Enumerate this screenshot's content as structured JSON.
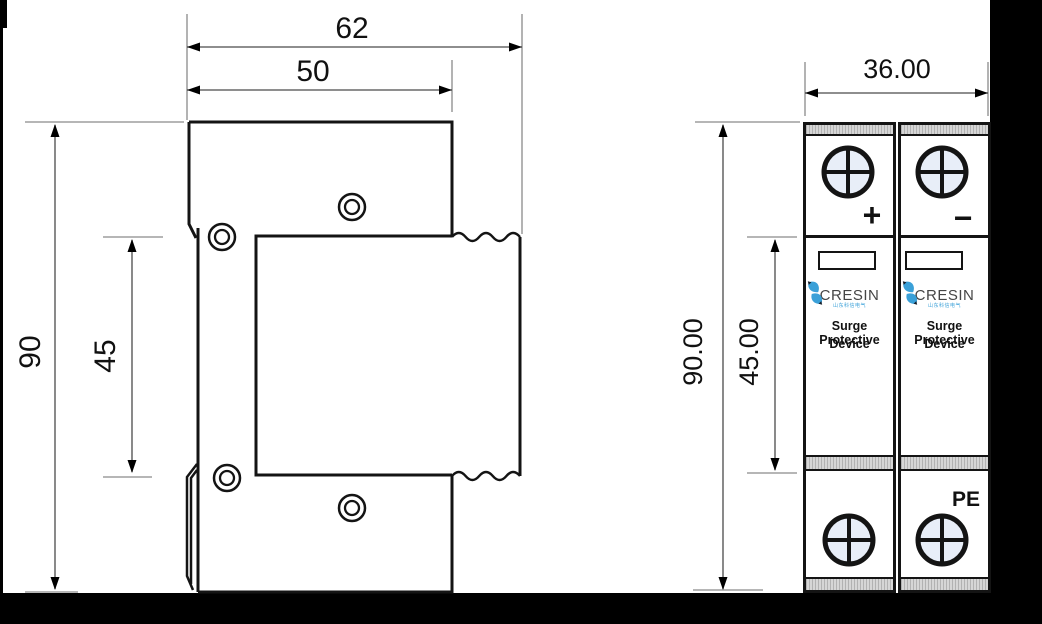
{
  "side_view": {
    "dim_width_overall": "62",
    "dim_width_body": "50",
    "dim_height_overall": "90",
    "dim_height_center": "45"
  },
  "front_view": {
    "dim_width": "36.00",
    "dim_height_overall": "90.00",
    "dim_height_module": "45.00",
    "modules": [
      {
        "polarity": "+",
        "brand": "CRESIN",
        "brand_sub": "山东科信电气",
        "label_line1": "Surge Protective",
        "label_line2": "Device"
      },
      {
        "polarity": "−",
        "brand": "CRESIN",
        "brand_sub": "山东科信电气",
        "label_line1": "Surge Protective",
        "label_line2": "Device",
        "corner_label": "PE"
      }
    ]
  },
  "colors": {
    "screw_fill": "#e8eef8",
    "strip_gray": "#d6d6d6",
    "logo_blue": "#3aa0d8",
    "line_black": "#141414"
  }
}
